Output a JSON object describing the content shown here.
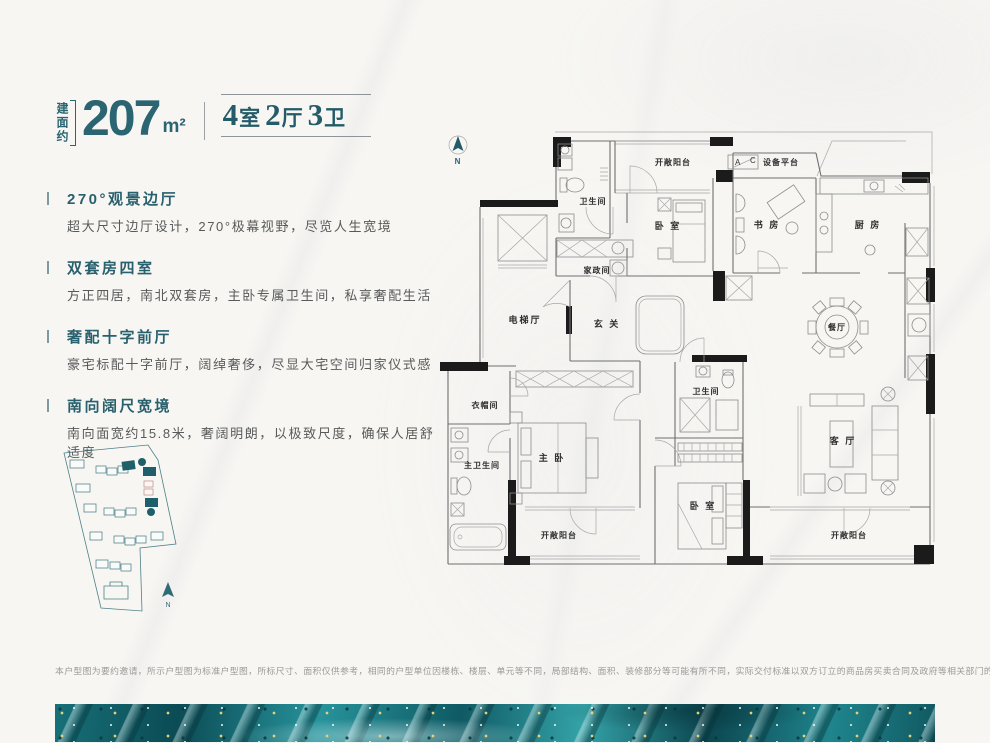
{
  "colors": {
    "accent": "#2a6571",
    "title_teal": "#29606d",
    "wall_black": "#1b1b1b",
    "strip_teal": "#1f858d"
  },
  "header": {
    "area_prefix": "建面约",
    "area_value": "207",
    "area_unit": "m²",
    "layout_parts": [
      {
        "num": "4",
        "unit": "室"
      },
      {
        "num": "2",
        "unit": "厅"
      },
      {
        "num": "3",
        "unit": "卫"
      }
    ]
  },
  "features": [
    {
      "title": "270°观景边厅",
      "desc": "超大尺寸边厅设计，270°极幕视野，尽览人生宽境"
    },
    {
      "title": "双套房四室",
      "desc": "方正四居，南北双套房，主卧专属卫生间，私享奢配生活"
    },
    {
      "title": "奢配十字前厅",
      "desc": "豪宅标配十字前厅，阔绰奢侈，尽显大宅空间归家仪式感"
    },
    {
      "title": "南向阔尺宽境",
      "desc": "南向面宽约15.8米，奢阔明朗，以极致尺度，确保人居舒适度"
    }
  ],
  "floorplan": {
    "compass": "N",
    "ac": {
      "a": "A",
      "c": "C"
    },
    "rooms": [
      {
        "label": "开敞阳台"
      },
      {
        "label": "设备平台"
      },
      {
        "label": "卫生间"
      },
      {
        "label": "卧 室"
      },
      {
        "label": "书 房"
      },
      {
        "label": "厨 房"
      },
      {
        "label": "家政间"
      },
      {
        "label": "电梯厅"
      },
      {
        "label": "玄 关"
      },
      {
        "label": "餐厅"
      },
      {
        "label": "衣帽间"
      },
      {
        "label": "卫生间"
      },
      {
        "label": "主卫生间"
      },
      {
        "label": "主 卧"
      },
      {
        "label": "卧 室"
      },
      {
        "label": "客 厅"
      },
      {
        "label": "开敞阳台"
      },
      {
        "label": "开敞阳台"
      }
    ]
  },
  "siteplan": {
    "compass": "N"
  },
  "disclaimer": "本户型图为要约邀请，所示户型图为标准户型图，所标尺寸、面积仅供参考，相同的户型单位因楼栋、楼层、单元等不同，局部结构、面积、装修部分等可能有所不同，实际交付标准以双方订立的商品房买卖合同及政府等相关部门的批准文件为准。本资料发布于2023年8月。"
}
